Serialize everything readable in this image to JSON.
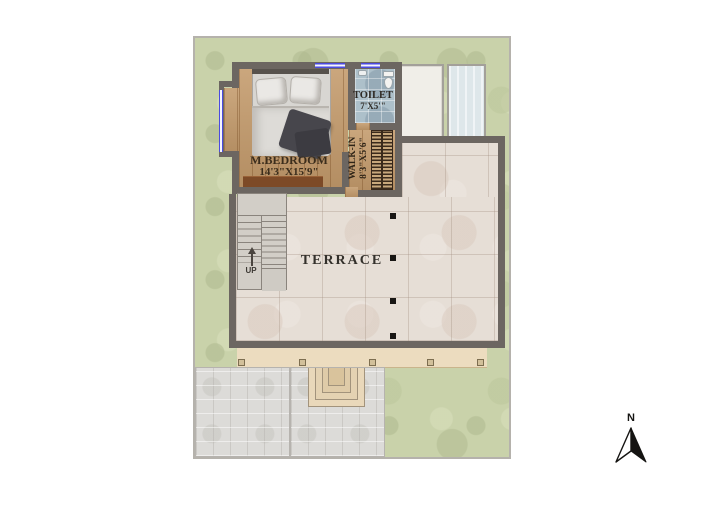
{
  "plan": {
    "bedroom": {
      "name": "M.BEDROOM",
      "dims": "14'3\"X15'9\""
    },
    "toilet": {
      "name": "TOILET",
      "dims": "7'X5'\""
    },
    "walkin": {
      "name": "WALK-IN",
      "dims": "8'3\"X5'6\""
    },
    "terrace": {
      "name": "TERRACE"
    },
    "stairs": {
      "label": "UP"
    },
    "compass": {
      "label": "N"
    }
  },
  "colors": {
    "grass": "#c9d2aa",
    "wall": "#6c6661",
    "wood_floor": "#c39a6b",
    "toilet_tile": "#adc0ca",
    "terrace_tile": "#e6ded6",
    "porch": "#ecdcbf",
    "paving": "#dcdbd8",
    "window_blue": "#4b4be0"
  }
}
